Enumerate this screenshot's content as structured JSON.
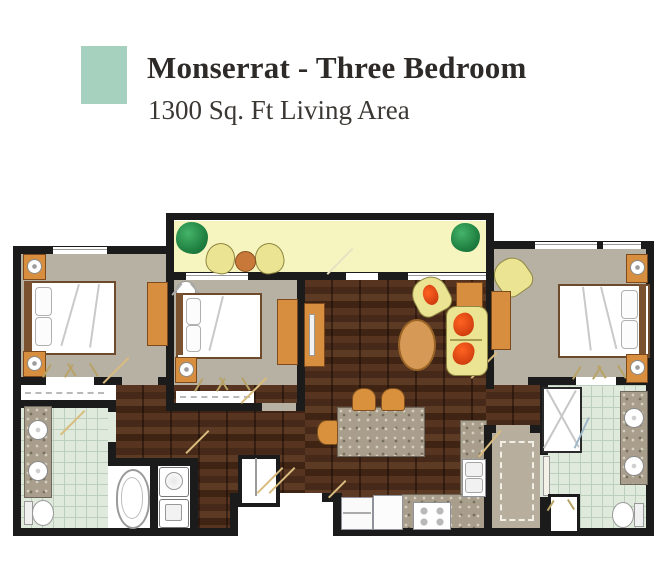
{
  "header": {
    "title": "Monserrat - Three Bedroom",
    "subtitle": "1300 Sq. Ft Living Area"
  },
  "legend": {
    "swatch_color": "#a6d1bf"
  },
  "palette": {
    "wall": "#1b1b1b",
    "wood_floor": "#4c2e1d",
    "bedroom_floor": "#b6b1a3",
    "tile_floor": "#dfe9dc",
    "balcony_floor": "#f6f4bf",
    "granite_counter": "#a89e8b",
    "furniture_wood": "#d78f3f",
    "upholstery_yellow": "#ebe492",
    "pillow_red": "#d03d0e",
    "tree_green": "#1f8040"
  },
  "floorplan": {
    "rooms": [
      "balcony",
      "bedroom-1",
      "bedroom-2",
      "bedroom-3",
      "living-room",
      "dining-area",
      "kitchen",
      "master-bathroom",
      "bathroom-2",
      "walk-in-closet",
      "laundry-closet",
      "hallway",
      "entry"
    ],
    "fixtures": [
      "beds",
      "nightstands",
      "dressers",
      "sofa",
      "armchairs",
      "coffee-table",
      "tv-console",
      "dining-island",
      "patio-set",
      "bathtub",
      "shower",
      "toilets",
      "double-vanities",
      "washer",
      "dryer",
      "stove",
      "refrigerator",
      "kitchen-sink"
    ]
  }
}
